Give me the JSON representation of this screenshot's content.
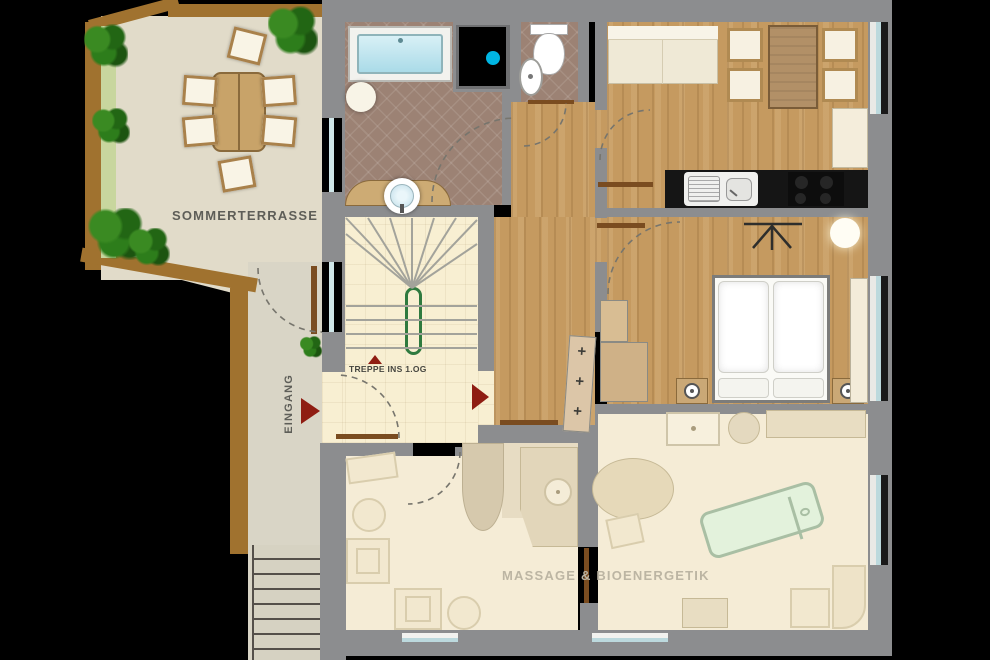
{
  "canvas": {
    "width": 990,
    "height": 660
  },
  "labels": {
    "terrace": "SOMMERTERRASSE",
    "entrance": "EINGANG",
    "stairs": "TREPPE INS 1.OG",
    "massage": "MASSAGE & BIOENERGETIK"
  },
  "stair_steps_marks": "+ + +",
  "colors": {
    "wall_gray": "#8c8d8f",
    "wood_floor": "#c59a60",
    "bath_tile": "#9c8274",
    "cream_tile": "#f8efd2",
    "terrace_floor": "#e1dbc9",
    "massage_floor": "#f5ecd6",
    "accent_red": "#8f1d12",
    "handrail_green": "#2f7a3f",
    "shower_dot_cyan": "#00b5e2",
    "massage_table_green": "#e3f2dc",
    "wood_border_brown": "#a0722f",
    "window_glass": "#bcd9dd"
  },
  "fixtures": [
    "bathtub",
    "shower",
    "toilet",
    "wash-basin",
    "vanity-sink",
    "kitchen-sink",
    "stove",
    "sofa",
    "dining-table",
    "terrace-table",
    "double-bed",
    "nightstand-lamp",
    "wardrobe",
    "massage-table",
    "staircase",
    "exterior-stairs",
    "plants",
    "door-swing-arcs"
  ]
}
